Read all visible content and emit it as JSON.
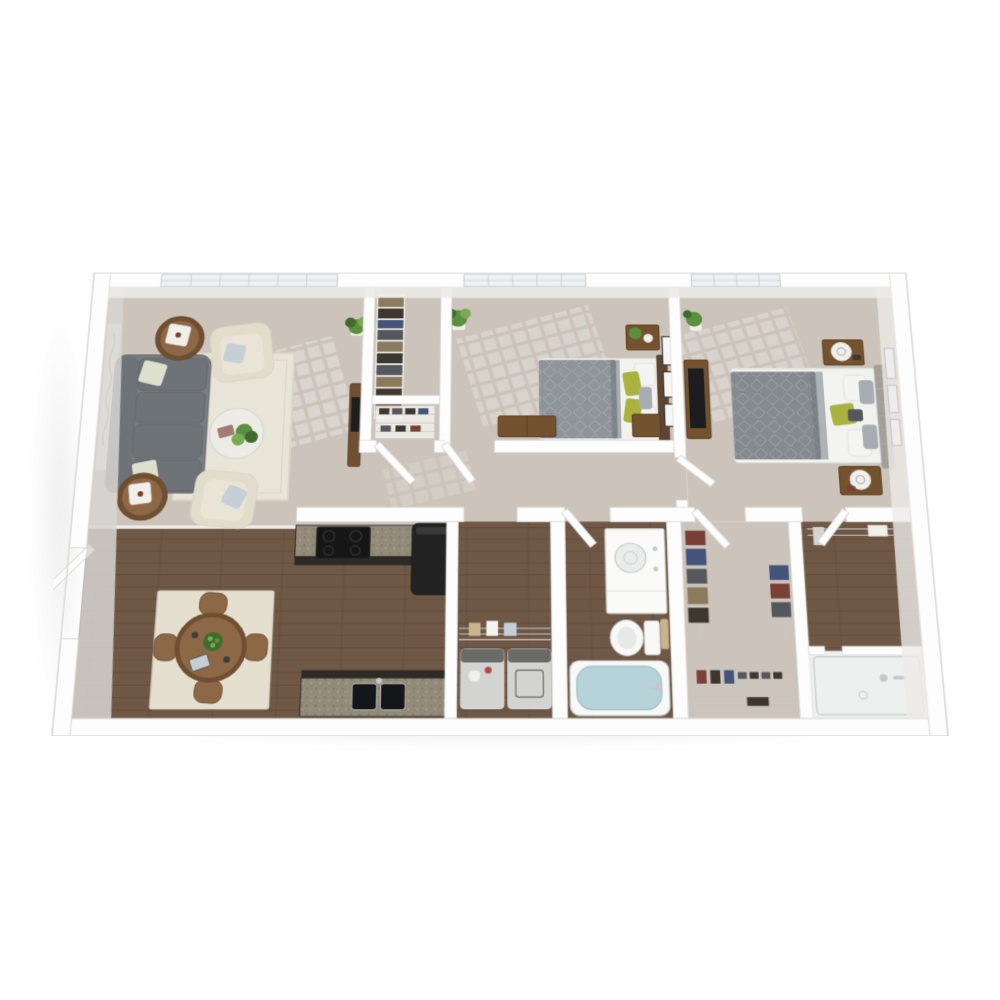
{
  "page": {
    "background": "#ffffff",
    "kind": "3d-floor-plan-rendering",
    "description": "Top-down 3D rendering of a two-bedroom, one-and-a-half-bath apartment floor plan on a white background. No text labels are visible in the image."
  },
  "palette": {
    "wall": "#fdfdfd",
    "wallEdge": "#d9d9d6",
    "wallFaceSide": "#d7d5d2",
    "wallFaceTop": "#ecebe8",
    "carpet": "#ccc4bb",
    "wood": "#6f5846",
    "woodLine": "#5a4635",
    "tile": "#eef0ef",
    "threshold": "#efece7",
    "windowGlass": "#eef1f3",
    "windowFrame": "#c3c9cc",
    "lightPatch": "#ffffff",
    "rugLiving": "#e9e4d8",
    "rugBorder": "#dcd5c6",
    "rugDining": "#e5dfcf",
    "sofa": "#6e7377",
    "sofaDark": "#5f6468",
    "sofaCushion": "#787d82",
    "pillowPattern": "#dde0cc",
    "armchair": "#e2dccd",
    "armchairCushion": "#eae4d6",
    "pillowBlue": "#c6cfd6",
    "tableWood": "#8c6847",
    "tableWoodDark": "#6f4f31",
    "glass": "#eff0ee",
    "plantDark": "#3f6b2e",
    "plant": "#5c8f3f",
    "plantLight": "#79ab53",
    "pot": "#f1efea",
    "art": "#fbfbf9",
    "artLine": "#8f8f8c",
    "mattress": "#f1f1ee",
    "duvetBed1": "#8e949a",
    "duvetDark": "#70767c",
    "duvetBed2": "#848a90",
    "sheet": "#f3f3f1",
    "accentGreen": "#a9b23f",
    "pillowWhite": "#f4f4f2",
    "pillowGray": "#a7adb3",
    "headboardWood": "#5e4531",
    "headboardTufted": "#a39f96",
    "nightstand": "#74522f",
    "nightstandDark": "#57391c",
    "frame": "#3d3d3b",
    "frameMat": "#f6f6f4",
    "tv": "#1b1d1f",
    "counterDark": "#2e2a26",
    "counterEdge": "#1e1b18",
    "granite": "#938b79",
    "graniteDot": "#6e6757",
    "stove": "#161616",
    "burner": "#303030",
    "fridge": "#222222",
    "sinkBasin": "#14161a",
    "chrome": "#c3c9ce",
    "machine": "#d3d3d1",
    "machinePanel": "#6a6a68",
    "knobRed": "#b34a42",
    "wire": "#c7c7c5",
    "towel": "#c9b48f",
    "clothRed": "#7a4038",
    "clothBlue": "#44537a",
    "clothGray": "#55575c",
    "clothTan": "#8a7a5e",
    "clothDark": "#3c372f",
    "vanity": "#fafaf8",
    "basin": "#e9eceb",
    "toilet": "#f8f8f6",
    "toiletSeat": "#e7e9e8",
    "tubWater": "#b7d3da",
    "tubWaterDeep": "#9cc0ca"
  },
  "plan": {
    "style": "white walls, beige carpet in living room and bedrooms, dark wood flooring in kitchen, dining, hallway closet, laundry and baths",
    "windows_count": 3,
    "rooms": [
      {
        "id": "living-room",
        "floor": "carpet",
        "window": true,
        "furniture": [
          "gray sofa",
          "two cream armchairs",
          "two round wood side tables with trays",
          "glass coffee table with plant",
          "cream area rug",
          "script wall art",
          "wood console"
        ]
      },
      {
        "id": "dining-area",
        "floor": "wood",
        "window": false,
        "furniture": [
          "round wood dining table",
          "four chairs",
          "cream area rug",
          "bowl of green apples",
          "tablet",
          "entry door"
        ]
      },
      {
        "id": "kitchen",
        "floor": "wood",
        "window": false,
        "furniture": [
          "counter with range",
          "granite countertops",
          "refrigerator",
          "counter with double sink"
        ]
      },
      {
        "id": "storage-closet",
        "floor": "carpet",
        "window": false,
        "furniture": [
          "wire shelving with clothes"
        ]
      },
      {
        "id": "linen-closet",
        "floor": "carpet",
        "window": false,
        "furniture": [
          "wire shelf with shoes"
        ]
      },
      {
        "id": "hallway",
        "floor": "carpet",
        "window": false,
        "furniture": []
      },
      {
        "id": "laundry-closet",
        "floor": "wood",
        "window": false,
        "furniture": [
          "washer",
          "dryer",
          "wire shelf with towels"
        ]
      },
      {
        "id": "bedroom-1",
        "floor": "carpet",
        "window": true,
        "furniture": [
          "bed with gray duvet and green pillows",
          "wood headboard",
          "nightstand with plant",
          "low dresser",
          "floor plant",
          "three wall frames"
        ]
      },
      {
        "id": "bedroom-2",
        "floor": "carpet",
        "window": true,
        "furniture": [
          "bed with gray duvet and green pillow",
          "tufted headboard",
          "two nightstands with white lamps",
          "media console with tv",
          "floor plant",
          "three wall frames"
        ]
      },
      {
        "id": "bathroom",
        "floor": "wood",
        "window": false,
        "furniture": [
          "vanity with round sink",
          "toilet",
          "towel bar",
          "bathtub with water"
        ]
      },
      {
        "id": "walk-in-closet",
        "floor": "carpet",
        "window": false,
        "furniture": [
          "hanging clothes rods",
          "wire shoe rack"
        ]
      },
      {
        "id": "shower-room",
        "floor": "wood",
        "window": false,
        "furniture": [
          "closet rod with shelf",
          "walk-in shower with chrome fixtures"
        ]
      }
    ],
    "doors": [
      "entry-door",
      "linen-closet-door",
      "bedroom-1-door",
      "bedroom-2-door",
      "bathroom-door",
      "walk-in-closet-door",
      "shower-room-door"
    ]
  }
}
